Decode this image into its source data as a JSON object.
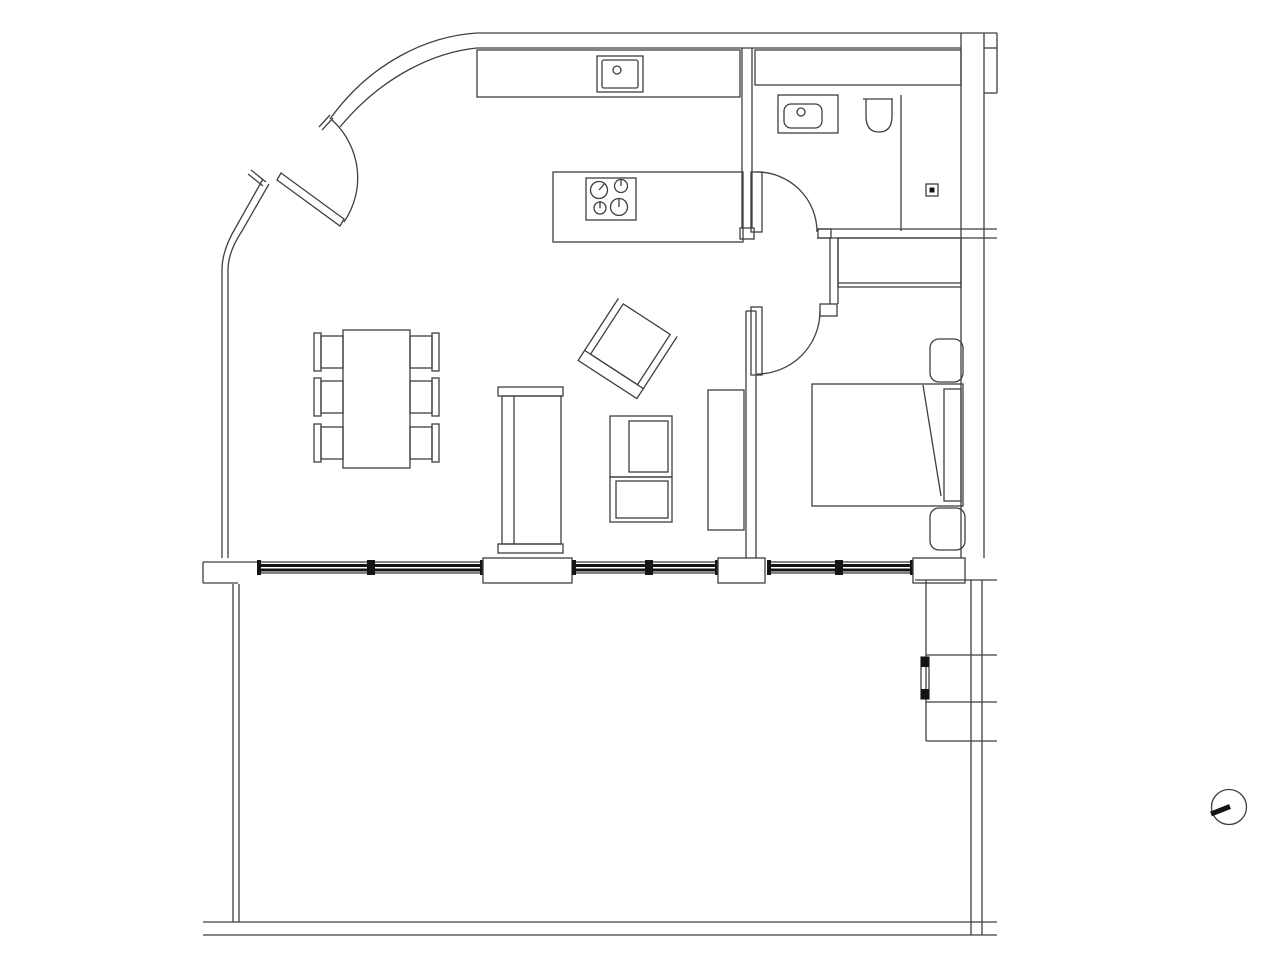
{
  "document": {
    "kind": "architectural-floor-plan",
    "visible_text": [],
    "background_color": "#ffffff"
  },
  "style": {
    "line_color": "#3f3f3f",
    "dark_line_color": "#141414",
    "paper_color": "#ffffff"
  },
  "plan": {
    "rooms": [
      {
        "name": "kitchen-living-area"
      },
      {
        "name": "bathroom"
      },
      {
        "name": "bedroom"
      },
      {
        "name": "hallway"
      },
      {
        "name": "terrace"
      }
    ],
    "fixtures": [
      {
        "name": "entry-door",
        "type": "swing-door"
      },
      {
        "name": "bathroom-door",
        "type": "swing-door"
      },
      {
        "name": "bedroom-door",
        "type": "swing-door"
      },
      {
        "name": "kitchen-counter",
        "type": "counter"
      },
      {
        "name": "kitchen-sink",
        "type": "sink"
      },
      {
        "name": "kitchen-island",
        "type": "counter"
      },
      {
        "name": "cooktop",
        "type": "4-burner-stove"
      },
      {
        "name": "bathroom-shelf",
        "type": "counter"
      },
      {
        "name": "bathroom-vanity",
        "type": "sink"
      },
      {
        "name": "toilet",
        "type": "wc"
      },
      {
        "name": "shower",
        "type": "shower-with-drain"
      },
      {
        "name": "wardrobe",
        "type": "closet"
      },
      {
        "name": "double-bed",
        "type": "bed"
      },
      {
        "name": "nightstand-upper",
        "type": "table"
      },
      {
        "name": "nightstand-lower",
        "type": "table"
      },
      {
        "name": "dining-table",
        "type": "table"
      },
      {
        "name": "dining-chairs",
        "type": "chair",
        "count": 6
      },
      {
        "name": "sofa",
        "type": "sofa"
      },
      {
        "name": "armchair",
        "type": "chair"
      },
      {
        "name": "media-unit",
        "type": "cabinet"
      },
      {
        "name": "sideboard",
        "type": "cabinet"
      },
      {
        "name": "windows",
        "type": "window-band",
        "count": 6
      },
      {
        "name": "north-marker",
        "type": "orientation-symbol"
      }
    ]
  }
}
